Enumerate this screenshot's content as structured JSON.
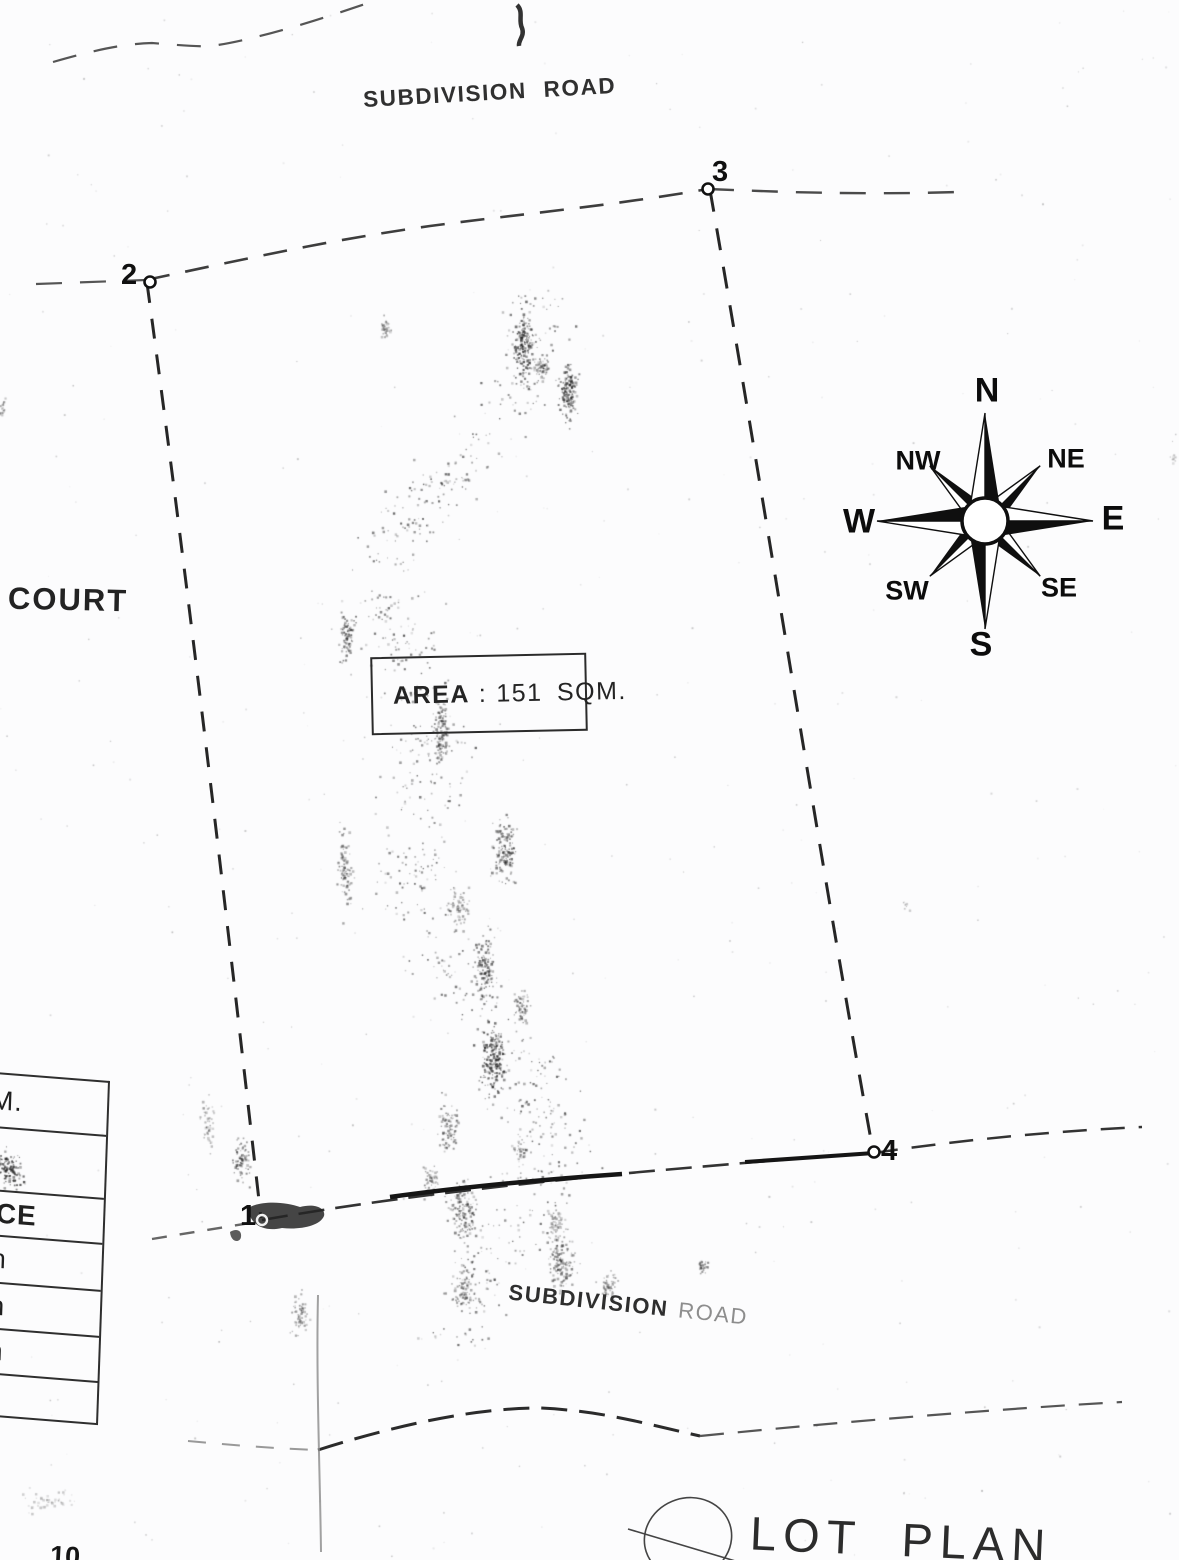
{
  "document": {
    "title": "LOT PLAN",
    "area_box": {
      "label": "AREA",
      "separator": ":",
      "value": "151 SQM."
    }
  },
  "roads": {
    "top_label": "SUBDIVISION ROAD",
    "bottom_label_main": "SUBDIVISION",
    "bottom_label_faint": "ROAD"
  },
  "adjacent_label": "COURT",
  "lot": {
    "area_text": "151 SQM.",
    "corners": [
      {
        "id": "1"
      },
      {
        "id": "2"
      },
      {
        "id": "3"
      },
      {
        "id": "4"
      }
    ]
  },
  "compass": {
    "n": "N",
    "ne": "NE",
    "e": "E",
    "se": "SE",
    "s": "S",
    "sw": "SW",
    "w": "W",
    "nw": "NW"
  },
  "side_table": {
    "rows": [
      {
        "text": "SQ.M."
      },
      {
        "text": ""
      },
      {
        "text": "TANCE"
      },
      {
        "text": "98 m"
      },
      {
        "text": "18 m"
      },
      {
        "text": "16 m"
      },
      {
        "text": "00 m"
      }
    ]
  },
  "fragments": {
    "bottom_left": "10"
  },
  "colors": {
    "ink": "#1c1c1c",
    "paper": "#fcfcfd",
    "faint_ink": "#8d8d8d"
  }
}
